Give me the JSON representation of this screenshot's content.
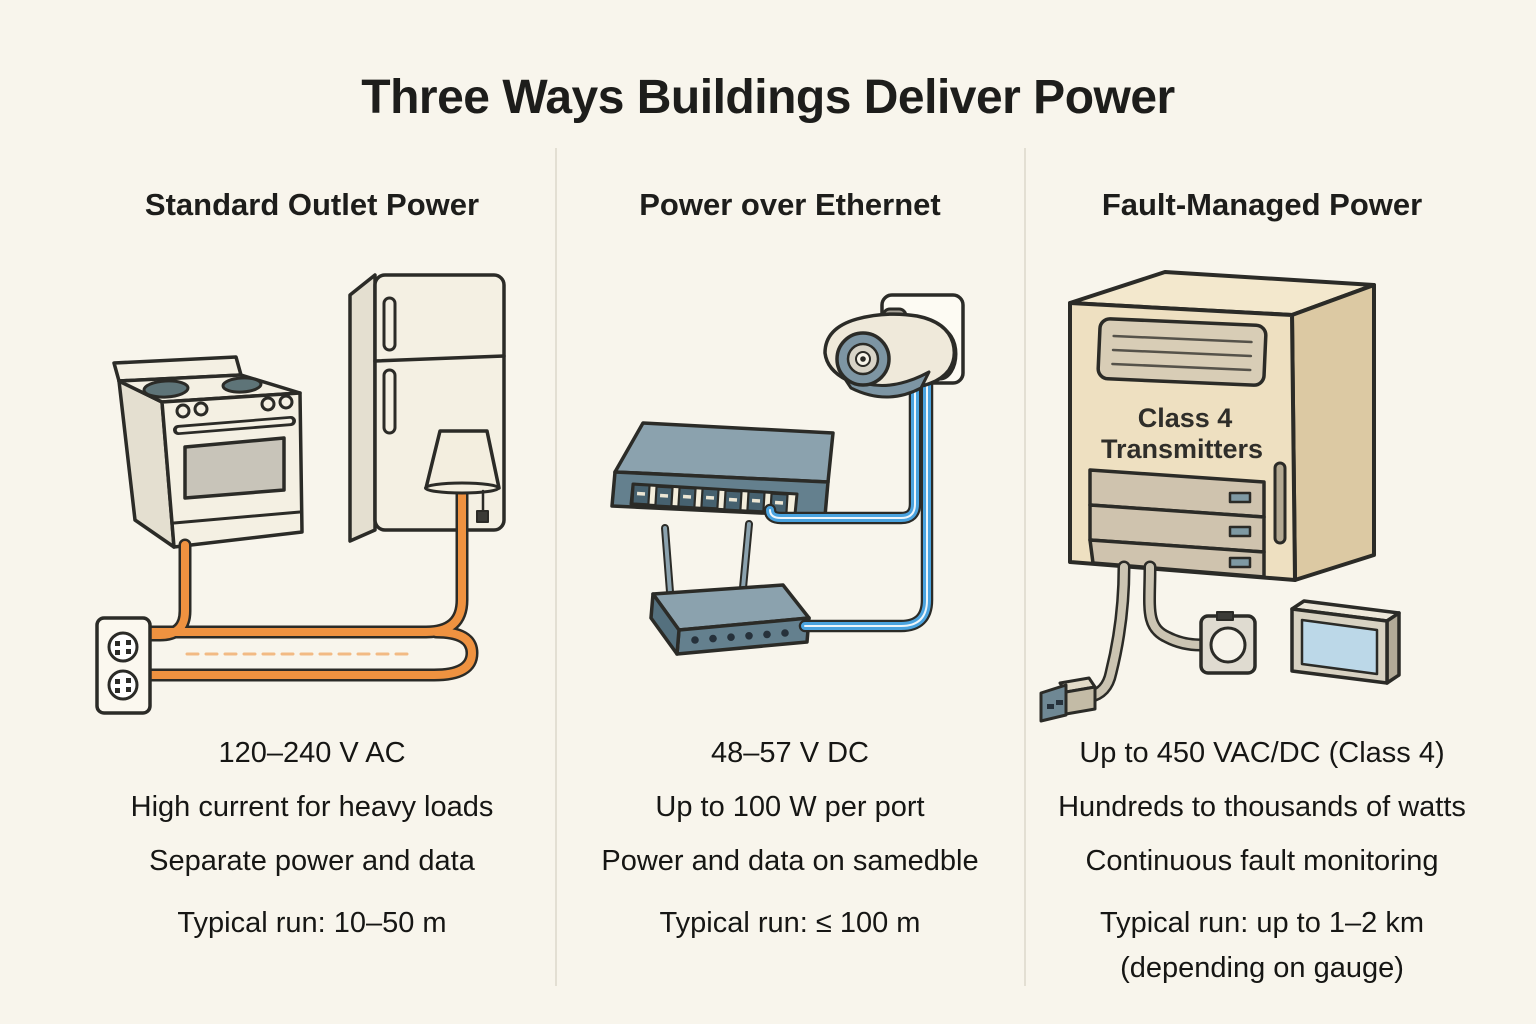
{
  "title": "Three Ways Buildings Deliver Power",
  "colors": {
    "background": "#F8F5EC",
    "text": "#1B1B19",
    "divider": "#E3DFD3",
    "outline": "#2B2B27",
    "power_cable_orange": "#EF9240",
    "ethernet_cable_blue": "#4AA3DF",
    "fmp_cable_gray": "#CBC4B2",
    "appliance_cream": "#F4F0E3",
    "device_slate": "#64808E",
    "cabinet_beige": "#EEE0C1",
    "screen_blue": "#BCD8E8"
  },
  "columns": [
    {
      "header": "Standard Outlet Power",
      "voltage": "120–240 V AC",
      "line2": "High current for heavy loads",
      "line3": "Separate power and data",
      "run": "Typical run: 10–50 m"
    },
    {
      "header": "Power over Ethernet",
      "voltage": "48–57 V DC",
      "line2": "Up to 100 W per port",
      "line3": "Power and data on samedble",
      "run": "Typical run: ≤ 100 m"
    },
    {
      "header": "Fault-Managed Power",
      "voltage": "Up to 450 VAC/DC (Class 4)",
      "line2": "Hundreds to thousands of watts",
      "line3": "Continuous fault monitoring",
      "run": "Typical run: up to 1–2 km",
      "run_note": "(depending on gauge)",
      "cabinet_label_line1": "Class 4",
      "cabinet_label_line2": "Transmitters"
    }
  ]
}
